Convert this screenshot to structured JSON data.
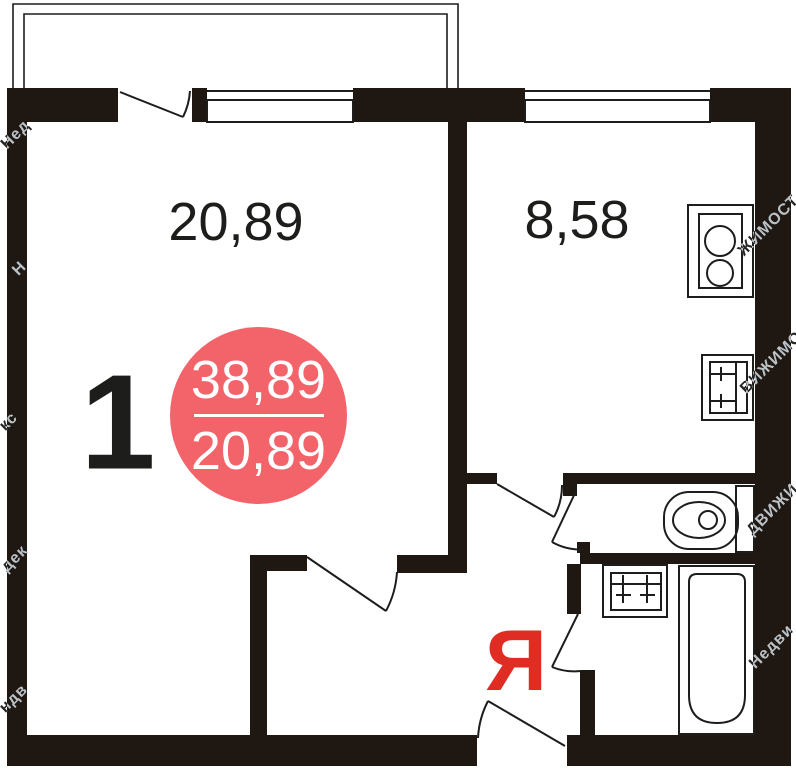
{
  "rooms": {
    "living": {
      "area": "20,89"
    },
    "kitchen": {
      "area": "8,58"
    }
  },
  "room_count": "1",
  "badge": {
    "total_area": "38,89",
    "living_area": "20,89"
  },
  "logo": "Я",
  "watermarks": {
    "l1": "Нед",
    "l2": "Н",
    "l3": "кс",
    "l4": "дек",
    "l5": "ндв",
    "r1": "ЖИМОСТ",
    "r2": "ВИЖИМО",
    "r3": "ДВИЖИ",
    "r4": "Недви"
  },
  "icons": [
    "stove-icon",
    "kitchen-sink-icon",
    "toilet-icon",
    "bathroom-sink-icon",
    "bathtub-icon"
  ],
  "colors": {
    "wall": "#1f1712",
    "line": "#1d1d1b",
    "badge_bg": "#f3646a",
    "logo_red": "#e02d24",
    "badge_text": "#ffffff",
    "label_text": "#1d1d1b",
    "watermark": "#d9d9d9"
  }
}
